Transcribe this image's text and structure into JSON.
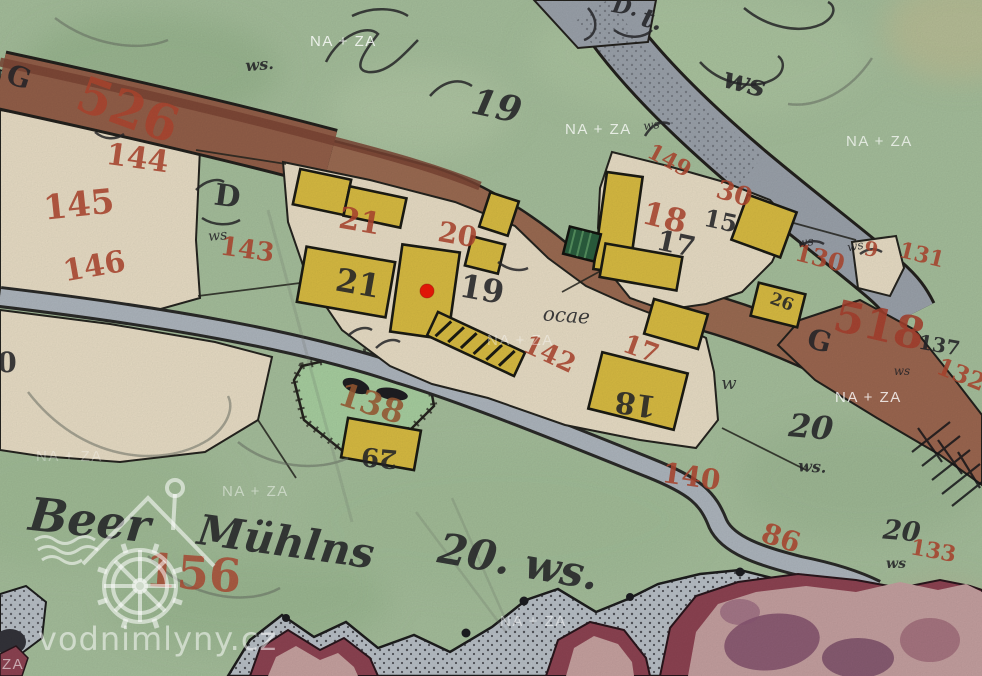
{
  "watermark": {
    "text": "NA + ZA",
    "positions": [
      {
        "x": 310,
        "y": 46,
        "o": 0.8
      },
      {
        "x": 565,
        "y": 134,
        "o": 0.75
      },
      {
        "x": 846,
        "y": 146,
        "o": 0.7
      },
      {
        "x": 36,
        "y": 461,
        "o": 0.3
      },
      {
        "x": 222,
        "y": 496,
        "o": 0.45
      },
      {
        "x": 487,
        "y": 345,
        "o": 0.4
      },
      {
        "x": 835,
        "y": 402,
        "o": 0.8
      },
      {
        "x": 500,
        "y": 626,
        "o": 0.5
      },
      {
        "t": "ZA",
        "x": 2,
        "y": 669,
        "o": 0.55
      }
    ]
  },
  "logo": {
    "text": "vodnimlyny.cz"
  },
  "marker": {
    "x": 427,
    "y": 291,
    "r": 7,
    "color": "#ee1908"
  },
  "map_labels": {
    "red": [
      {
        "t": "526",
        "x": 122,
        "y": 126,
        "s": 50,
        "r": 20
      },
      {
        "t": "144",
        "x": 136,
        "y": 168,
        "s": 30,
        "r": 8
      },
      {
        "t": "145",
        "x": 80,
        "y": 216,
        "s": 34,
        "r": -6
      },
      {
        "t": "146",
        "x": 96,
        "y": 276,
        "s": 30,
        "r": -10
      },
      {
        "t": "143",
        "x": 246,
        "y": 258,
        "s": 26,
        "r": 8
      },
      {
        "t": "21",
        "x": 358,
        "y": 231,
        "s": 30,
        "r": 10
      },
      {
        "t": "20",
        "x": 456,
        "y": 244,
        "s": 28,
        "r": 10
      },
      {
        "t": "142",
        "x": 546,
        "y": 362,
        "s": 26,
        "r": 25
      },
      {
        "t": "17",
        "x": 638,
        "y": 357,
        "s": 26,
        "r": 20
      },
      {
        "t": "149",
        "x": 666,
        "y": 167,
        "s": 22,
        "r": 28
      },
      {
        "t": "18",
        "x": 662,
        "y": 228,
        "s": 32,
        "r": 14
      },
      {
        "t": "30",
        "x": 732,
        "y": 202,
        "s": 26,
        "r": 16
      },
      {
        "t": "130",
        "x": 818,
        "y": 266,
        "s": 24,
        "r": 14
      },
      {
        "t": "9",
        "x": 870,
        "y": 256,
        "s": 20,
        "r": 10
      },
      {
        "t": "131",
        "x": 920,
        "y": 262,
        "s": 22,
        "r": 14
      },
      {
        "t": "518",
        "x": 876,
        "y": 340,
        "s": 44,
        "r": 13,
        "f": "#a8402e"
      },
      {
        "t": "132",
        "x": 958,
        "y": 382,
        "s": 24,
        "r": 22
      },
      {
        "t": "140",
        "x": 690,
        "y": 486,
        "s": 28,
        "r": 8
      },
      {
        "t": "86",
        "x": 778,
        "y": 547,
        "s": 28,
        "r": 18
      },
      {
        "t": "133",
        "x": 932,
        "y": 558,
        "s": 22,
        "r": 10
      },
      {
        "t": "156",
        "x": 192,
        "y": 589,
        "s": 46,
        "r": 4,
        "o": 0.8
      },
      {
        "t": "138",
        "x": 368,
        "y": 414,
        "s": 32,
        "r": 18,
        "f": "#9c5a34"
      }
    ],
    "black": [
      {
        "t": "G",
        "x": 16,
        "y": 86,
        "s": 28,
        "r": 18
      },
      {
        "t": "D",
        "x": 226,
        "y": 206,
        "s": 30,
        "r": 8
      },
      {
        "t": "ws",
        "x": 218,
        "y": 240,
        "s": 14,
        "r": -5,
        "i": 1
      },
      {
        "t": "21",
        "x": 356,
        "y": 294,
        "s": 32,
        "r": 10
      },
      {
        "t": "19",
        "x": 480,
        "y": 300,
        "s": 32,
        "r": 10
      },
      {
        "t": "ocae",
        "x": 566,
        "y": 322,
        "s": 20,
        "r": 4,
        "i": 1
      },
      {
        "t": "17",
        "x": 674,
        "y": 253,
        "s": 28,
        "r": 12
      },
      {
        "t": "15",
        "x": 719,
        "y": 229,
        "s": 24,
        "r": 12
      },
      {
        "t": "18",
        "x": 637,
        "y": 394,
        "s": 30,
        "r": 188
      },
      {
        "t": "29",
        "x": 380,
        "y": 449,
        "s": 26,
        "r": 185
      },
      {
        "t": "26",
        "x": 780,
        "y": 307,
        "s": 17,
        "r": 20
      },
      {
        "t": "w",
        "x": 729,
        "y": 389,
        "s": 18,
        "r": 0,
        "i": 1
      },
      {
        "t": "137",
        "x": 938,
        "y": 352,
        "s": 20,
        "r": 10
      },
      {
        "t": "G",
        "x": 817,
        "y": 350,
        "s": 28,
        "r": 15
      },
      {
        "t": "0",
        "x": 7,
        "y": 372,
        "s": 28,
        "r": 0
      },
      {
        "t": "ws",
        "x": 652,
        "y": 129,
        "s": 12,
        "r": -8,
        "i": 1
      },
      {
        "t": "ws",
        "x": 806,
        "y": 246,
        "s": 12,
        "r": -8,
        "i": 1
      },
      {
        "t": "ws",
        "x": 856,
        "y": 250,
        "s": 12,
        "r": -10,
        "i": 1
      },
      {
        "t": "ws",
        "x": 902,
        "y": 375,
        "s": 12,
        "r": 0,
        "i": 1
      }
    ],
    "script": [
      {
        "t": "Beer",
        "x": 88,
        "y": 536,
        "s": 46,
        "r": 6
      },
      {
        "t": "Mühlns",
        "x": 284,
        "y": 556,
        "s": 42,
        "r": 8
      },
      {
        "t": "20. ws.",
        "x": 516,
        "y": 576,
        "s": 42,
        "r": 10
      },
      {
        "t": "19",
        "x": 494,
        "y": 118,
        "s": 36,
        "r": 12
      },
      {
        "t": "ws.",
        "x": 260,
        "y": 70,
        "s": 16,
        "r": -5
      },
      {
        "t": "D.",
        "x": 624,
        "y": 14,
        "s": 22,
        "r": 10
      },
      {
        "t": "t.",
        "x": 650,
        "y": 28,
        "s": 26,
        "r": 15
      },
      {
        "t": "ws",
        "x": 742,
        "y": 92,
        "s": 30,
        "r": 15
      },
      {
        "t": "20",
        "x": 810,
        "y": 438,
        "s": 32,
        "r": 5
      },
      {
        "t": "ws.",
        "x": 812,
        "y": 472,
        "s": 16,
        "r": 3
      },
      {
        "t": "20",
        "x": 901,
        "y": 540,
        "s": 27,
        "r": 5
      },
      {
        "t": "ws",
        "x": 896,
        "y": 568,
        "s": 14,
        "r": 0
      }
    ]
  },
  "colors": {
    "background": "#a6bf9c",
    "parcel_beige": "#e9dec6",
    "building_yellow": "#d9bc42",
    "building_green": "#2b5e3e",
    "road_brown": "#9b6b52",
    "road_gray": "#9ba2ab",
    "stream": "#aeb6be",
    "rock_maroon": "#8d4352",
    "label_red": "#b04730",
    "label_black": "#26262a",
    "marker_red": "#ee1908",
    "watermark": "#ffffff"
  }
}
